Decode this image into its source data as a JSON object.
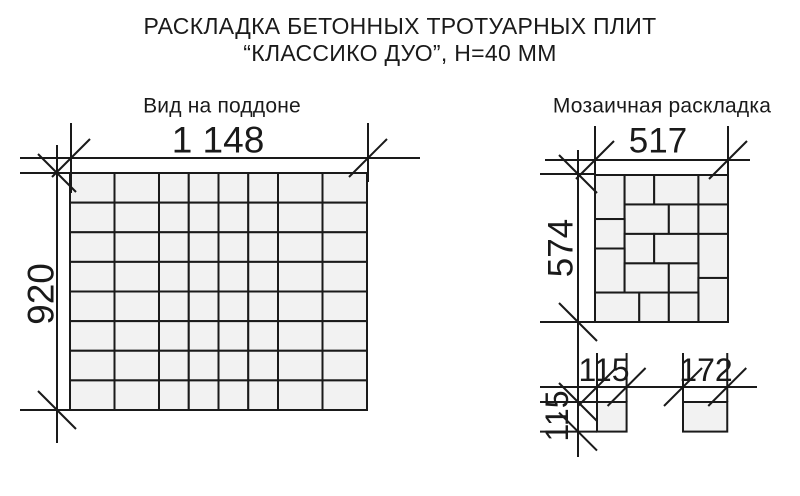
{
  "title": {
    "line1": "РАСКЛАДКА БЕТОННЫХ ТРОТУАРНЫХ ПЛИТ",
    "line2": "“КЛАССИКО ДУО”, Н=40 ММ"
  },
  "sections": {
    "pallet": {
      "heading": "Вид на поддоне",
      "width_label": "1 148",
      "height_label": "920",
      "width_mm": 1148,
      "height_mm": 920,
      "columns_mm": [
        172,
        172,
        115,
        115,
        115,
        115,
        172,
        172
      ],
      "rows_mm": [
        115,
        115,
        115,
        115,
        115,
        115,
        115,
        115
      ]
    },
    "mosaic": {
      "heading": "Мозаичная раскладка",
      "width_label": "517",
      "height_label": "574",
      "width_mm": 517,
      "height_mm": 574,
      "tiles_mm": [
        [
          0,
          0,
          115,
          172
        ],
        [
          115,
          0,
          115,
          115
        ],
        [
          230,
          0,
          172,
          115
        ],
        [
          402,
          0,
          115,
          115
        ],
        [
          115,
          115,
          172,
          115
        ],
        [
          287,
          115,
          115,
          115
        ],
        [
          402,
          115,
          115,
          115
        ],
        [
          0,
          172,
          115,
          115
        ],
        [
          115,
          230,
          115,
          115
        ],
        [
          230,
          230,
          172,
          115
        ],
        [
          402,
          230,
          115,
          172
        ],
        [
          0,
          287,
          115,
          172
        ],
        [
          115,
          345,
          172,
          115
        ],
        [
          287,
          345,
          115,
          115
        ],
        [
          402,
          402,
          115,
          172
        ],
        [
          0,
          459,
          172,
          115
        ],
        [
          172,
          459,
          115,
          115
        ],
        [
          287,
          459,
          115,
          115
        ]
      ]
    },
    "detail": {
      "square_width_label": "115",
      "square_height_label": "115",
      "rect_width_label": "172",
      "square_mm": [
        115,
        115
      ],
      "rect_mm": [
        172,
        115
      ]
    }
  },
  "colors": {
    "background": "#ffffff",
    "line": "#1a1a1a",
    "tile_fill": "#f2f2f2"
  }
}
